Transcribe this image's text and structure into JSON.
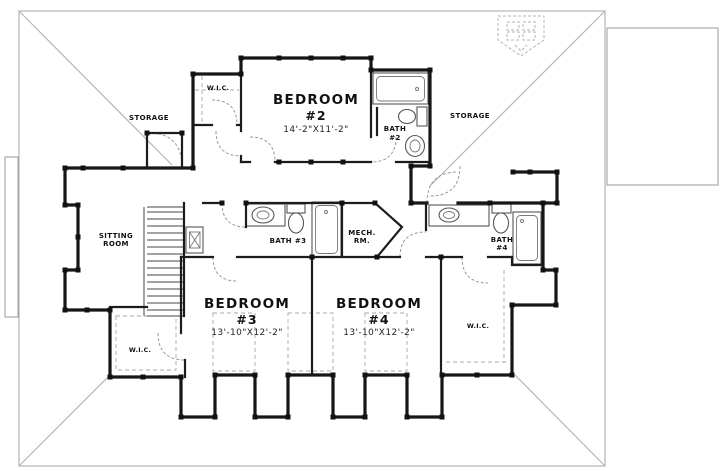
{
  "plan": {
    "rooms": {
      "bedroom2": {
        "name": "BEDROOM",
        "number": "#2",
        "dims": "14'-2\"X11'-2\""
      },
      "bedroom3": {
        "name": "BEDROOM",
        "number": "#3",
        "dims": "13'-10\"X12'-2\""
      },
      "bedroom4": {
        "name": "BEDROOM",
        "number": "#4",
        "dims": "13'-10\"X12'-2\""
      },
      "bath2": {
        "line1": "BATH",
        "line2": "#2"
      },
      "bath3": {
        "label": "BATH #3"
      },
      "bath4": {
        "line1": "BATH",
        "line2": "#4"
      },
      "mech": {
        "line1": "MECH.",
        "line2": "RM."
      },
      "sitting": {
        "line1": "SITTING",
        "line2": "ROOM"
      },
      "wic_top": {
        "label": "W.I.C."
      },
      "wic_left": {
        "label": "W.I.C."
      },
      "wic_right": {
        "label": "W.I.C."
      },
      "storage_left": {
        "label": "STORAGE"
      },
      "storage_right": {
        "label": "STORAGE"
      }
    },
    "colors": {
      "wall": "#161616",
      "fixture": "#555555",
      "eave": "#b5b5b5",
      "dash": "#999999"
    }
  }
}
